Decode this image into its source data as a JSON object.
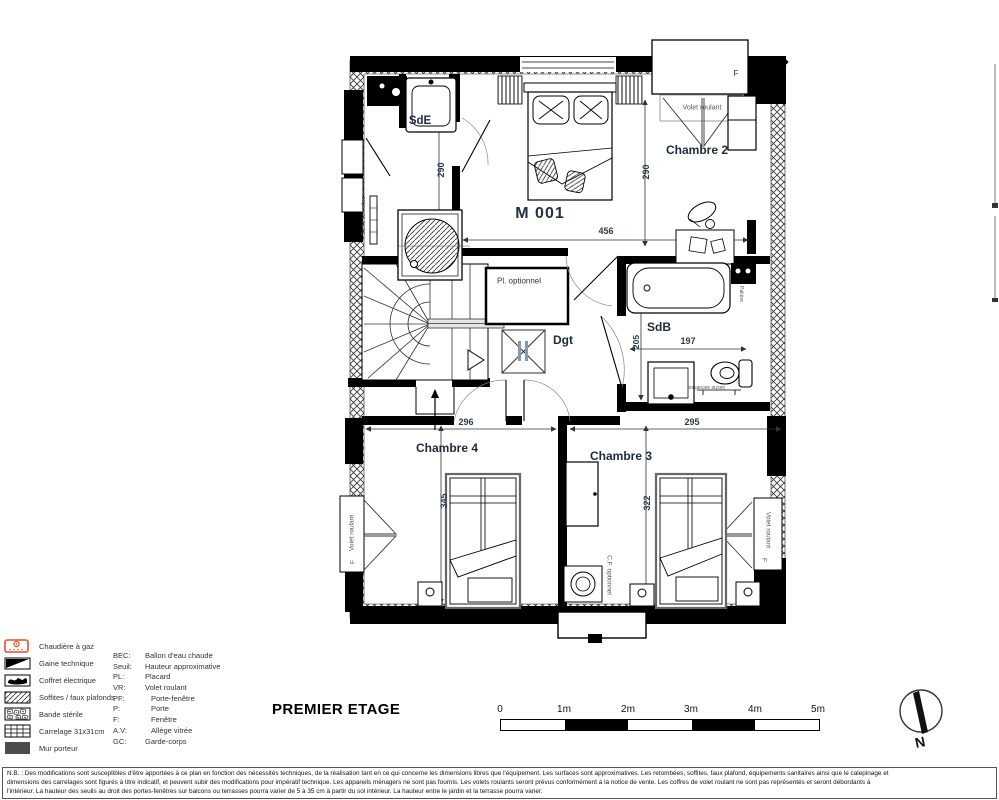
{
  "title": "PREMIER ETAGE",
  "plan": {
    "unit": "M 001",
    "rooms": {
      "sde": "SdE",
      "chambre2": "Chambre 2",
      "sdb": "SdB",
      "dgt": "Dgt",
      "chambre4": "Chambre 4",
      "chambre3": "Chambre 3"
    },
    "labels": {
      "pl_optionnel": "Pl. optionnel",
      "volet_roulant": "Volet roulant",
      "seche_serviettes": "Sèche serviettes",
      "cf_optionnel": "C.F. optionnel",
      "paliere": "Palière",
      "window": "F"
    },
    "dims": {
      "d456": "456",
      "d290a": "290",
      "d290b": "290",
      "d205": "205",
      "d197": "197",
      "d296": "296",
      "d295": "295",
      "d345": "345",
      "d322": "322"
    }
  },
  "legend": {
    "items": [
      {
        "icon": "chaudiere-gaz-icon",
        "label": "Chaudière à gaz"
      },
      {
        "icon": "gaine-technique-icon",
        "label": "Gaine technique"
      },
      {
        "icon": "coffret-electrique-icon",
        "label": "Coffret électrique"
      },
      {
        "icon": "soffites-faux-plafonds-icon",
        "label": "Soffites / faux plafonds"
      },
      {
        "icon": "bande-sterile-icon",
        "label": "Bande stérile"
      },
      {
        "icon": "carrelage-icon",
        "label": "Carrelage 31x31cm"
      },
      {
        "icon": "mur-porteur-icon",
        "label": "Mur porteur"
      }
    ],
    "abbr": [
      {
        "abbr": "BEC:",
        "def": "Ballon d'eau chaude"
      },
      {
        "abbr": "Seuil:",
        "def": "Hauteur approximative"
      },
      {
        "abbr": "PL:",
        "def": "Placard"
      },
      {
        "abbr": "VR:",
        "def": "Volet roulant"
      },
      {
        "abbr": "PF:",
        "def": "Porte-fenêtre"
      },
      {
        "abbr": "P:",
        "def": "Porte"
      },
      {
        "abbr": "F:",
        "def": "Fenêtre"
      },
      {
        "abbr": "A.V:",
        "def": "Allège vitrée"
      },
      {
        "abbr": "GC:",
        "def": "Garde-corps"
      }
    ]
  },
  "scalebar": {
    "labels": [
      "0",
      "1m",
      "2m",
      "3m",
      "4m",
      "5m"
    ]
  },
  "compass": {
    "north": "N"
  },
  "note": {
    "lines": [
      "N.B. : Des modifications sont susceptibles d'être apportées à ce plan en fonction des nécessités techniques, de la réalisation tant en ce qui concerne les dimensions libres que l'équipement. Les surfaces sont approximatives. Les retombées, soffites, faux plafond, équipements sanitaires ainsi que le calepinage et",
      "dimensions des carrelages sont figurés à titre indicatif, et peuvent subir des modifications pour impératif technique. Les appareils ménagers ne sont pas fournis. Les volets roulants seront prévus conformément à la notice de vente. Les coffres de volet roulant ne sont pas représentés et seront débordants à",
      "l'intérieur. La hauteur des seuils au droit des portes-fenêtres sur balcons ou terrasses pourra varier de 5 à 35 cm à partir du sol intérieur. La hauteur entre le jardin et la terrasse pourra varier."
    ]
  },
  "colors": {
    "accent": "#e8502d",
    "wall": "#000000",
    "label": "#1d2b3a"
  }
}
